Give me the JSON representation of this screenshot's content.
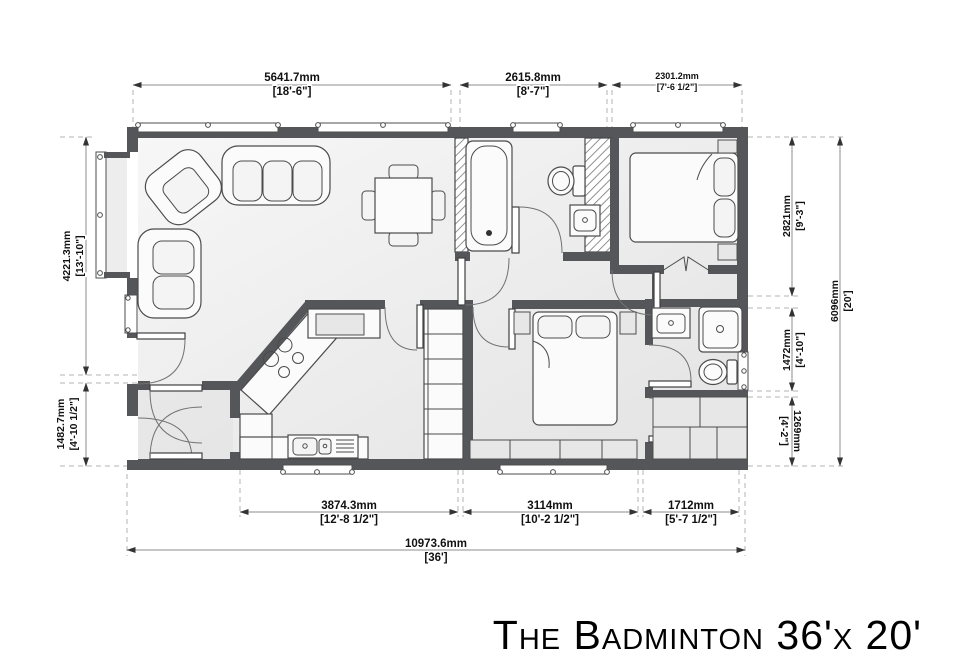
{
  "title": "The Badminton 36'x 20'",
  "dims": {
    "top": [
      {
        "mm": "5641.7mm",
        "ft": "[18'-6\"]"
      },
      {
        "mm": "2615.8mm",
        "ft": "[8'-7\"]"
      },
      {
        "mm": "2301.2mm",
        "ft": "[7'-6 1/2\"]"
      }
    ],
    "bottom": [
      {
        "mm": "3874.3mm",
        "ft": "[12'-8 1/2\"]"
      },
      {
        "mm": "3114mm",
        "ft": "[10'-2 1/2\"]"
      },
      {
        "mm": "1712mm",
        "ft": "[5'-7 1/2\"]"
      }
    ],
    "bottom_overall": {
      "mm": "10973.6mm",
      "ft": "[36']"
    },
    "left": [
      {
        "mm": "4221.3mm",
        "ft": "[13'-10\"]"
      },
      {
        "mm": "1482.7mm",
        "ft": "[4'-10 1/2\"]"
      }
    ],
    "right": [
      {
        "mm": "2821mm",
        "ft": "[9'-3\"]"
      },
      {
        "mm": "1472mm",
        "ft": "[4'-10\"]"
      },
      {
        "mm": "1269mm",
        "ft": "[4'-2\"]"
      }
    ],
    "right_overall": {
      "mm": "6096mm",
      "ft": "[20']"
    }
  },
  "colors": {
    "wall": "#55565a",
    "floor": "#f0f0f0",
    "hatch": "#777777"
  }
}
